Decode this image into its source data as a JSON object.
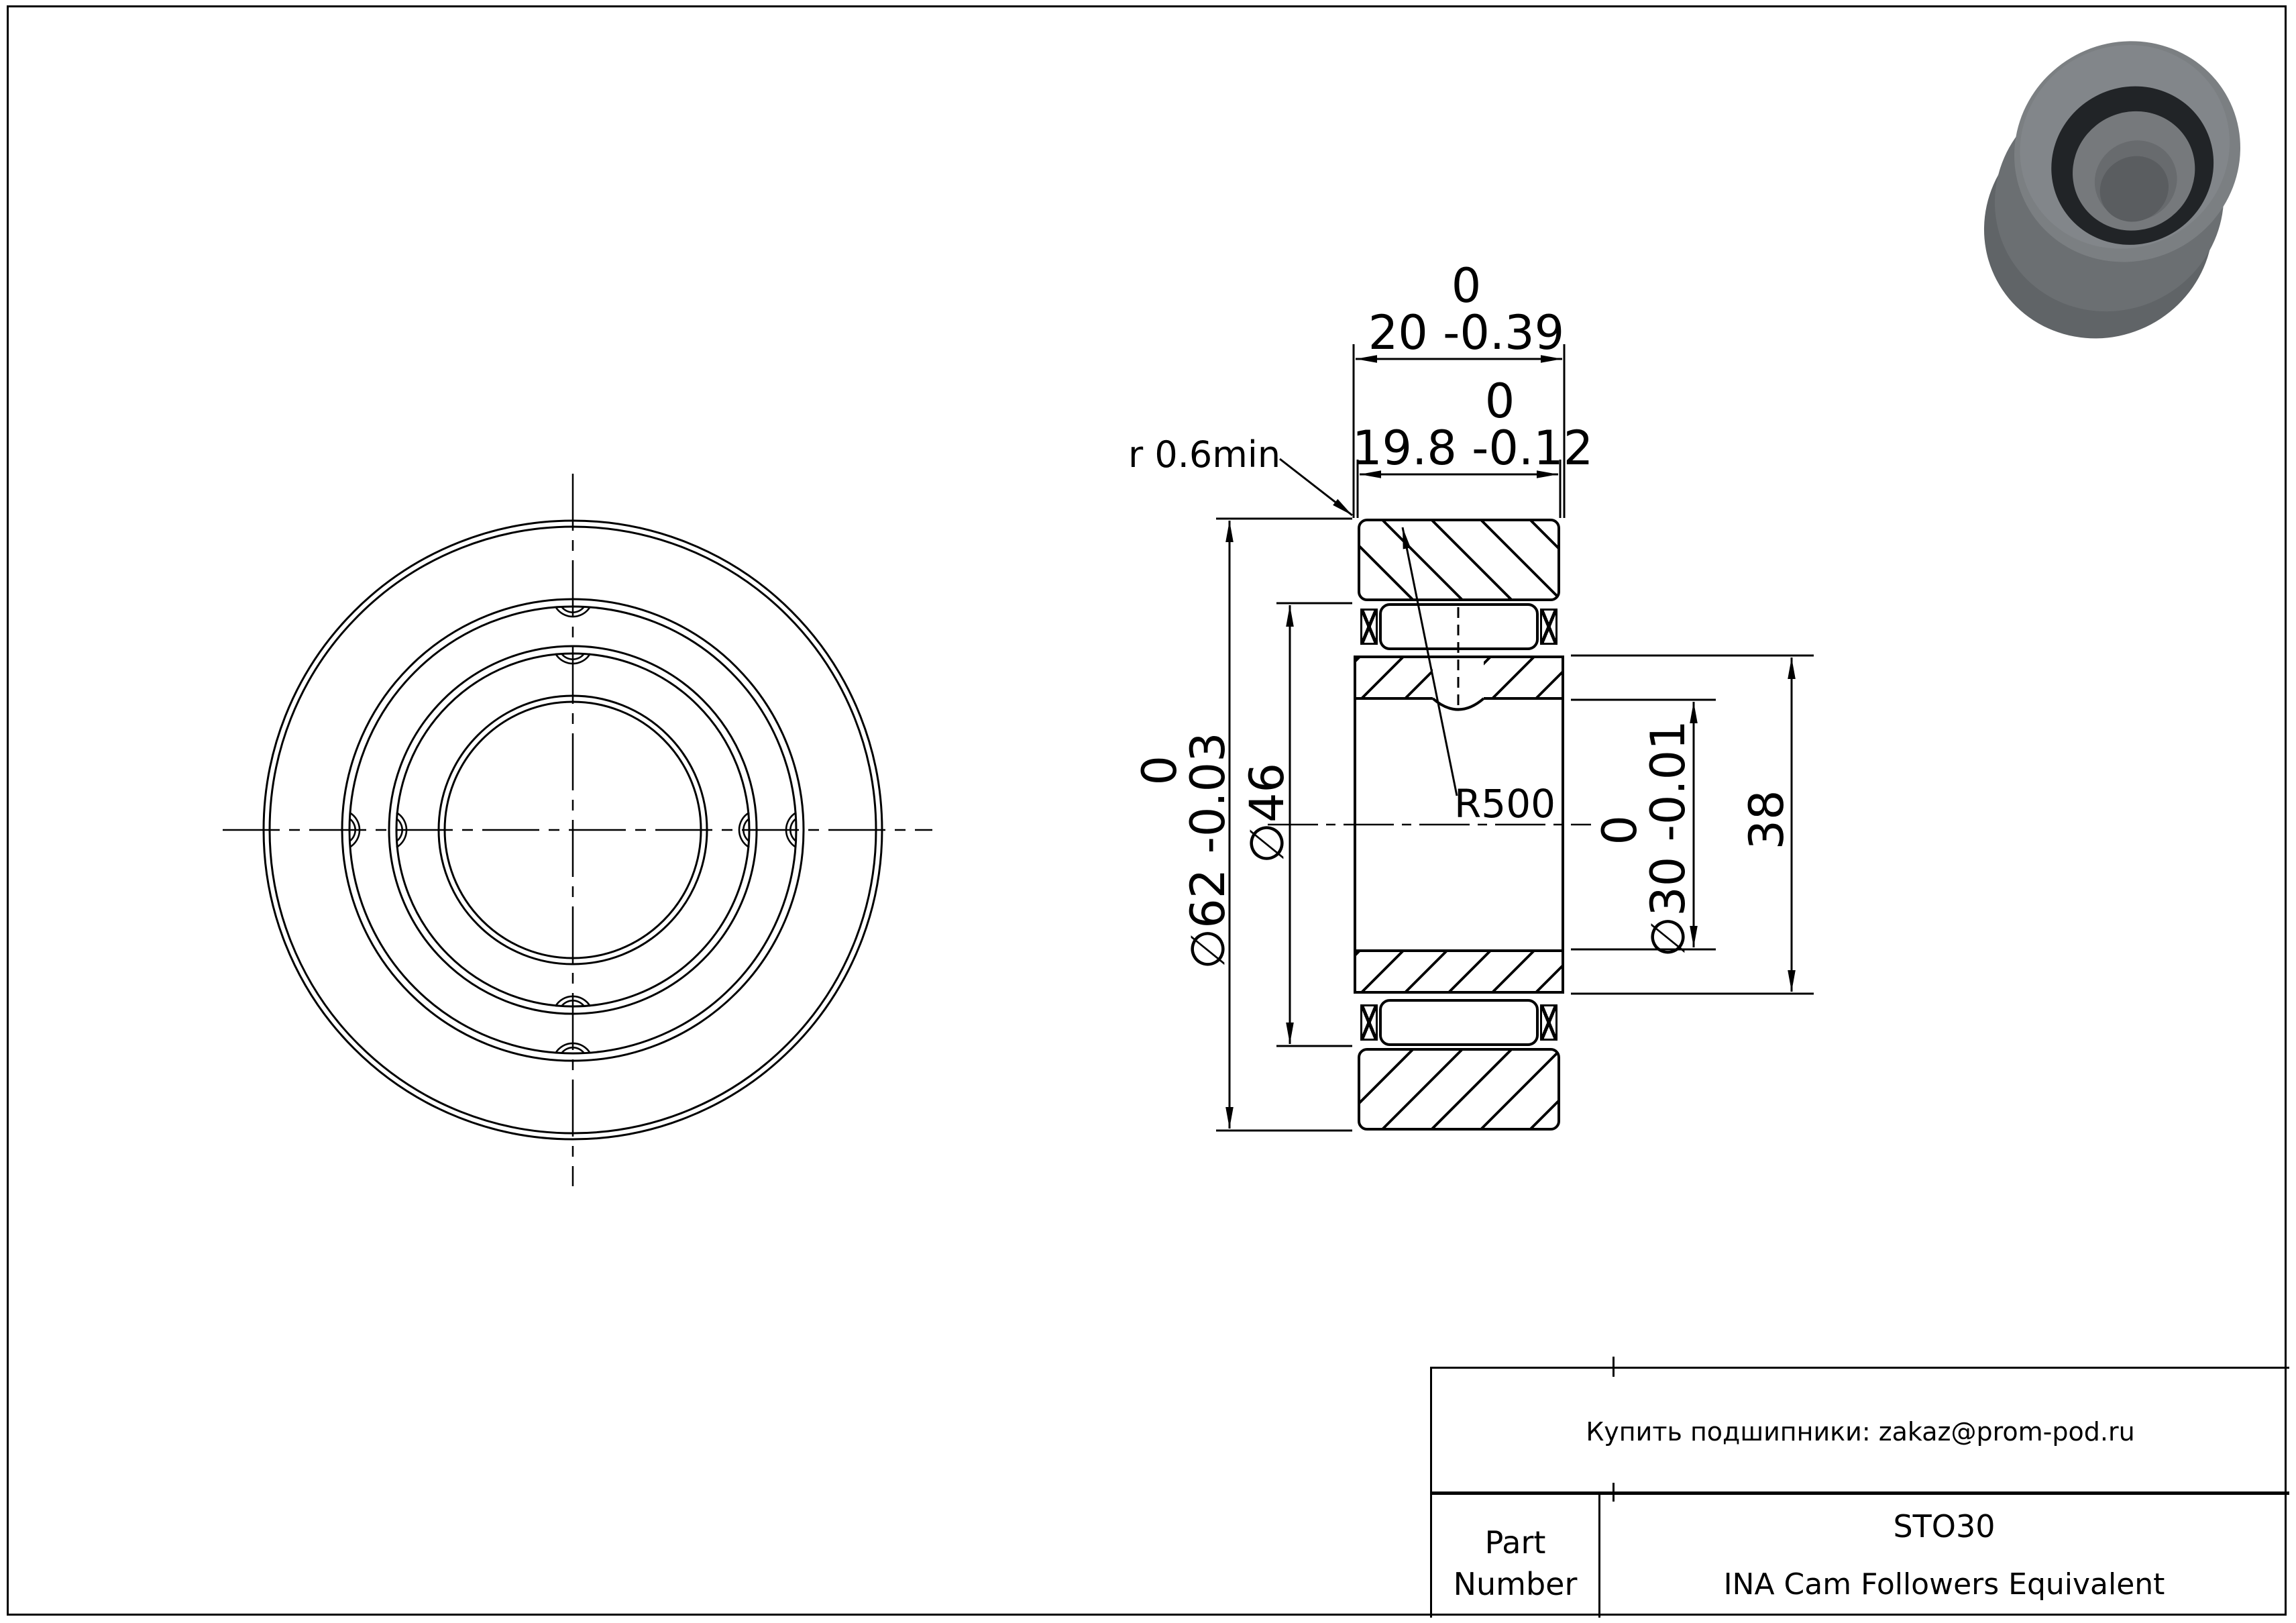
{
  "labels": {
    "width_outer_upper": "0",
    "width_outer": "20 -0.39",
    "width_inner_upper": "0",
    "width_inner": "19.8 -0.12",
    "edge_radius": "r 0.6min",
    "crown_radius": "R500",
    "od_upper": "0",
    "od": "∅62 -0.03",
    "cage_od": "∅46",
    "bore_upper": "0",
    "bore": "∅30 -0.01",
    "inner_race_od": "38"
  },
  "title_block": {
    "contact": "Купить подшипники: zakaz@prom-pod.ru",
    "part_label_line1": "Part",
    "part_label_line2": "Number",
    "part_number": "STO30",
    "description": "INA Cam Followers Equivalent"
  },
  "colors": {
    "line": "#000000",
    "render_body": "#6e7275",
    "render_face": "#7b7f82",
    "render_seal": "#212427",
    "render_bore": "#686b6e"
  }
}
